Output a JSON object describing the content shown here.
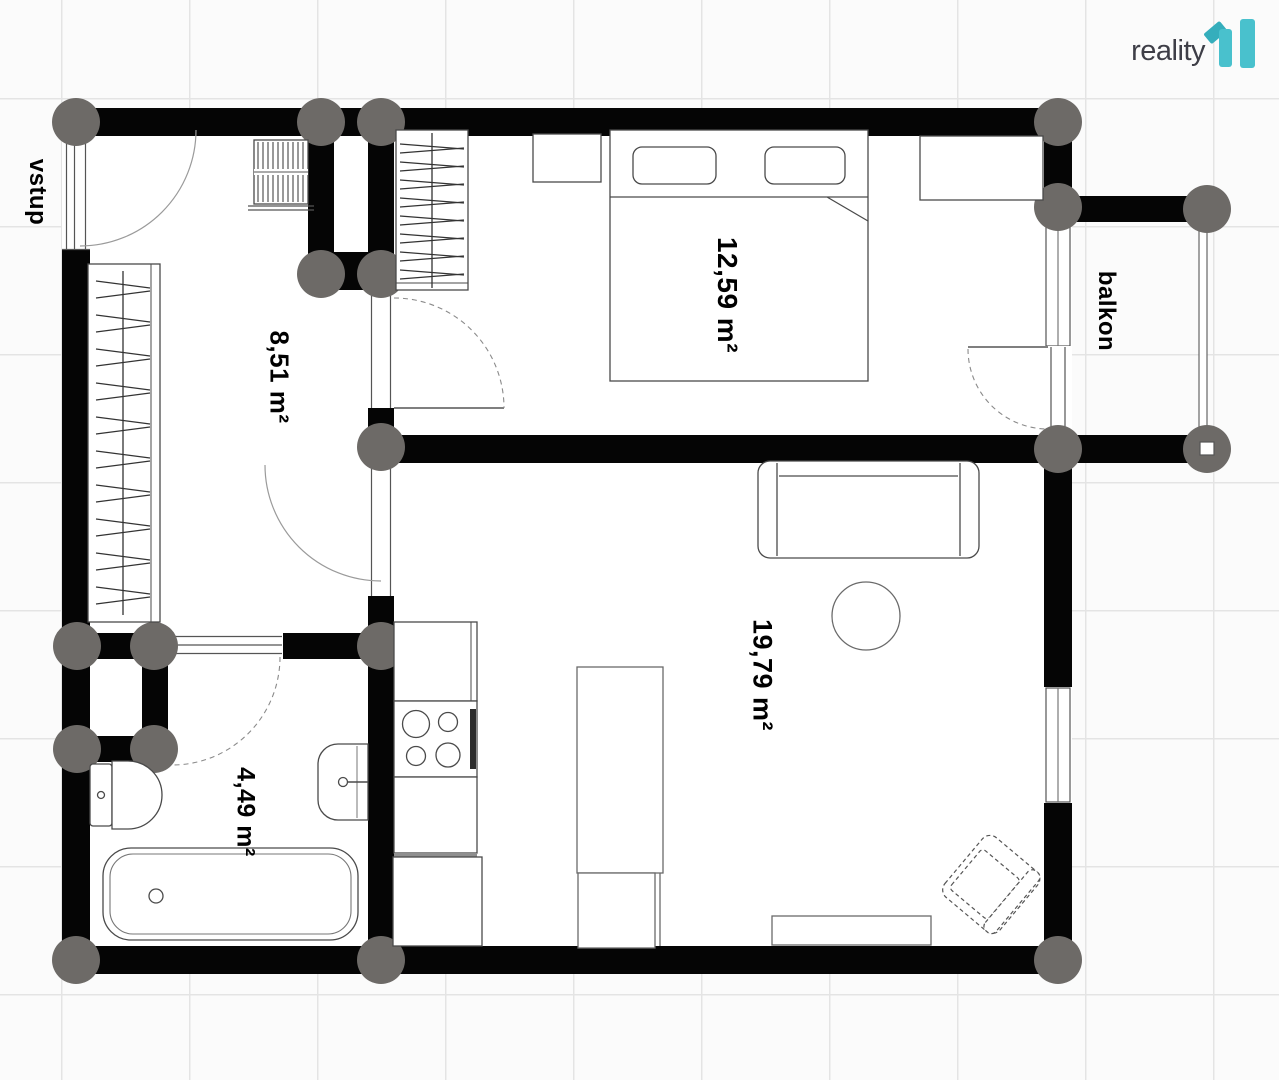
{
  "meta": {
    "type": "floor-plan"
  },
  "logo": {
    "brand": "reality",
    "mark": "11"
  },
  "labels": {
    "entrance": "vstup",
    "balcony": "balkon"
  },
  "rooms": [
    {
      "name": "entrance-hall",
      "area_label": "8,51 m²"
    },
    {
      "name": "bedroom",
      "area_label": "12,59 m²"
    },
    {
      "name": "bathroom",
      "area_label": "4,49 m²"
    },
    {
      "name": "living-room-kitchen",
      "area_label": "19,79 m²"
    }
  ],
  "colors": {
    "wall": "#050505",
    "joint": "#6d6a67",
    "furniture_stroke": "#4a4a4a",
    "accent_teal": "#49c1cd",
    "accent_teal_dark": "#35aebc",
    "grid_line": "#e4e4e4",
    "label": "#000000"
  }
}
